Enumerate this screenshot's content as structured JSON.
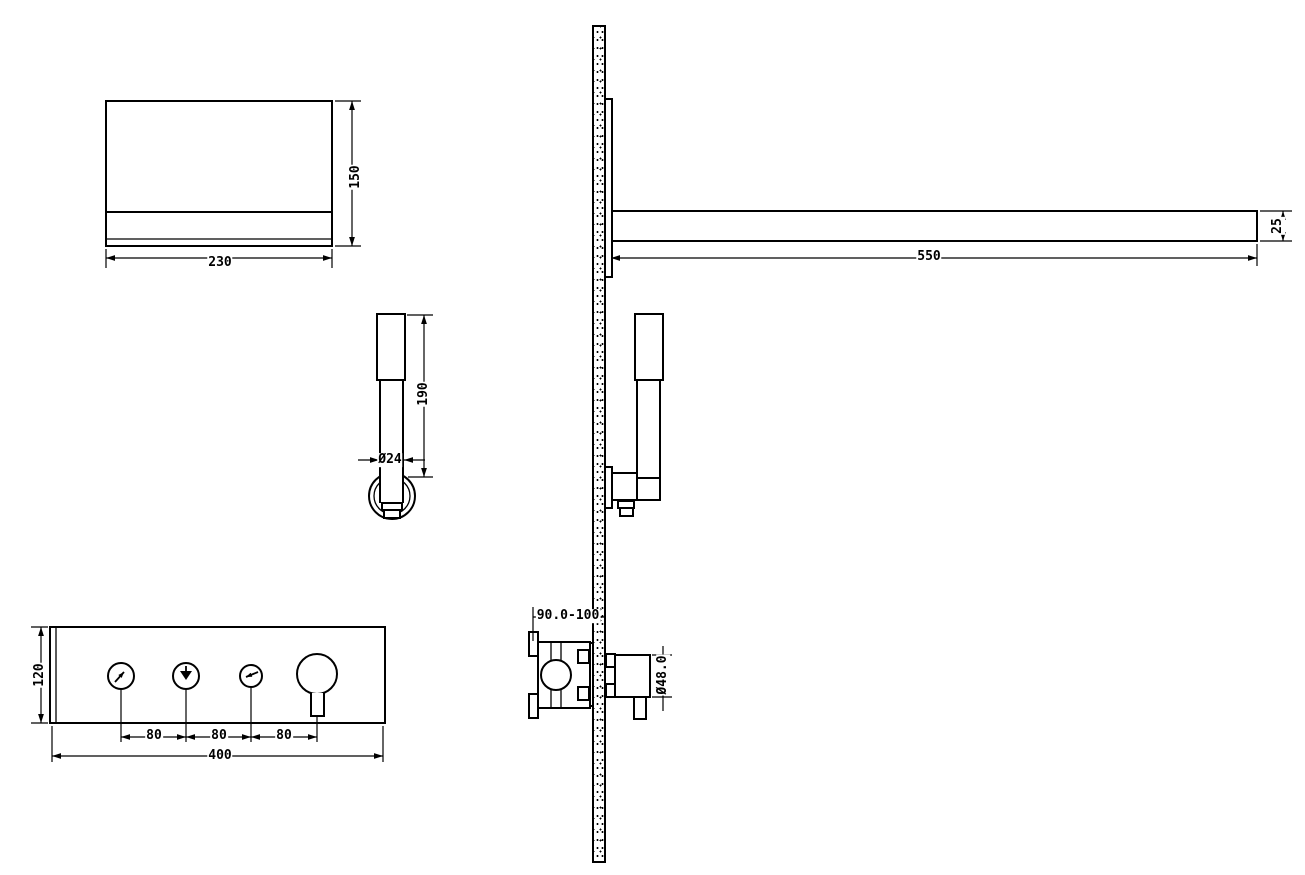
{
  "colors": {
    "background": "#ffffff",
    "line_color": "#000000"
  },
  "dimension_labels": {
    "shower_head": {
      "width": "230",
      "height": "150"
    },
    "shower_arm": {
      "length": "550",
      "thickness": "25"
    },
    "hand_shower": {
      "length": "190",
      "diameter": "Ø24"
    },
    "control_panel": {
      "height": "120",
      "button_spacing_1": "80",
      "button_spacing_2": "80",
      "button_spacing_3": "80",
      "width": "400"
    },
    "mixer_valve": {
      "embed_depth_range": "90.0-100",
      "knob_diameter": "Ø48.0"
    }
  },
  "icons": {
    "button_1": "handshower-spray-icon",
    "button_2": "rain-spray-icon",
    "button_3": "spout-arrow-icon"
  }
}
